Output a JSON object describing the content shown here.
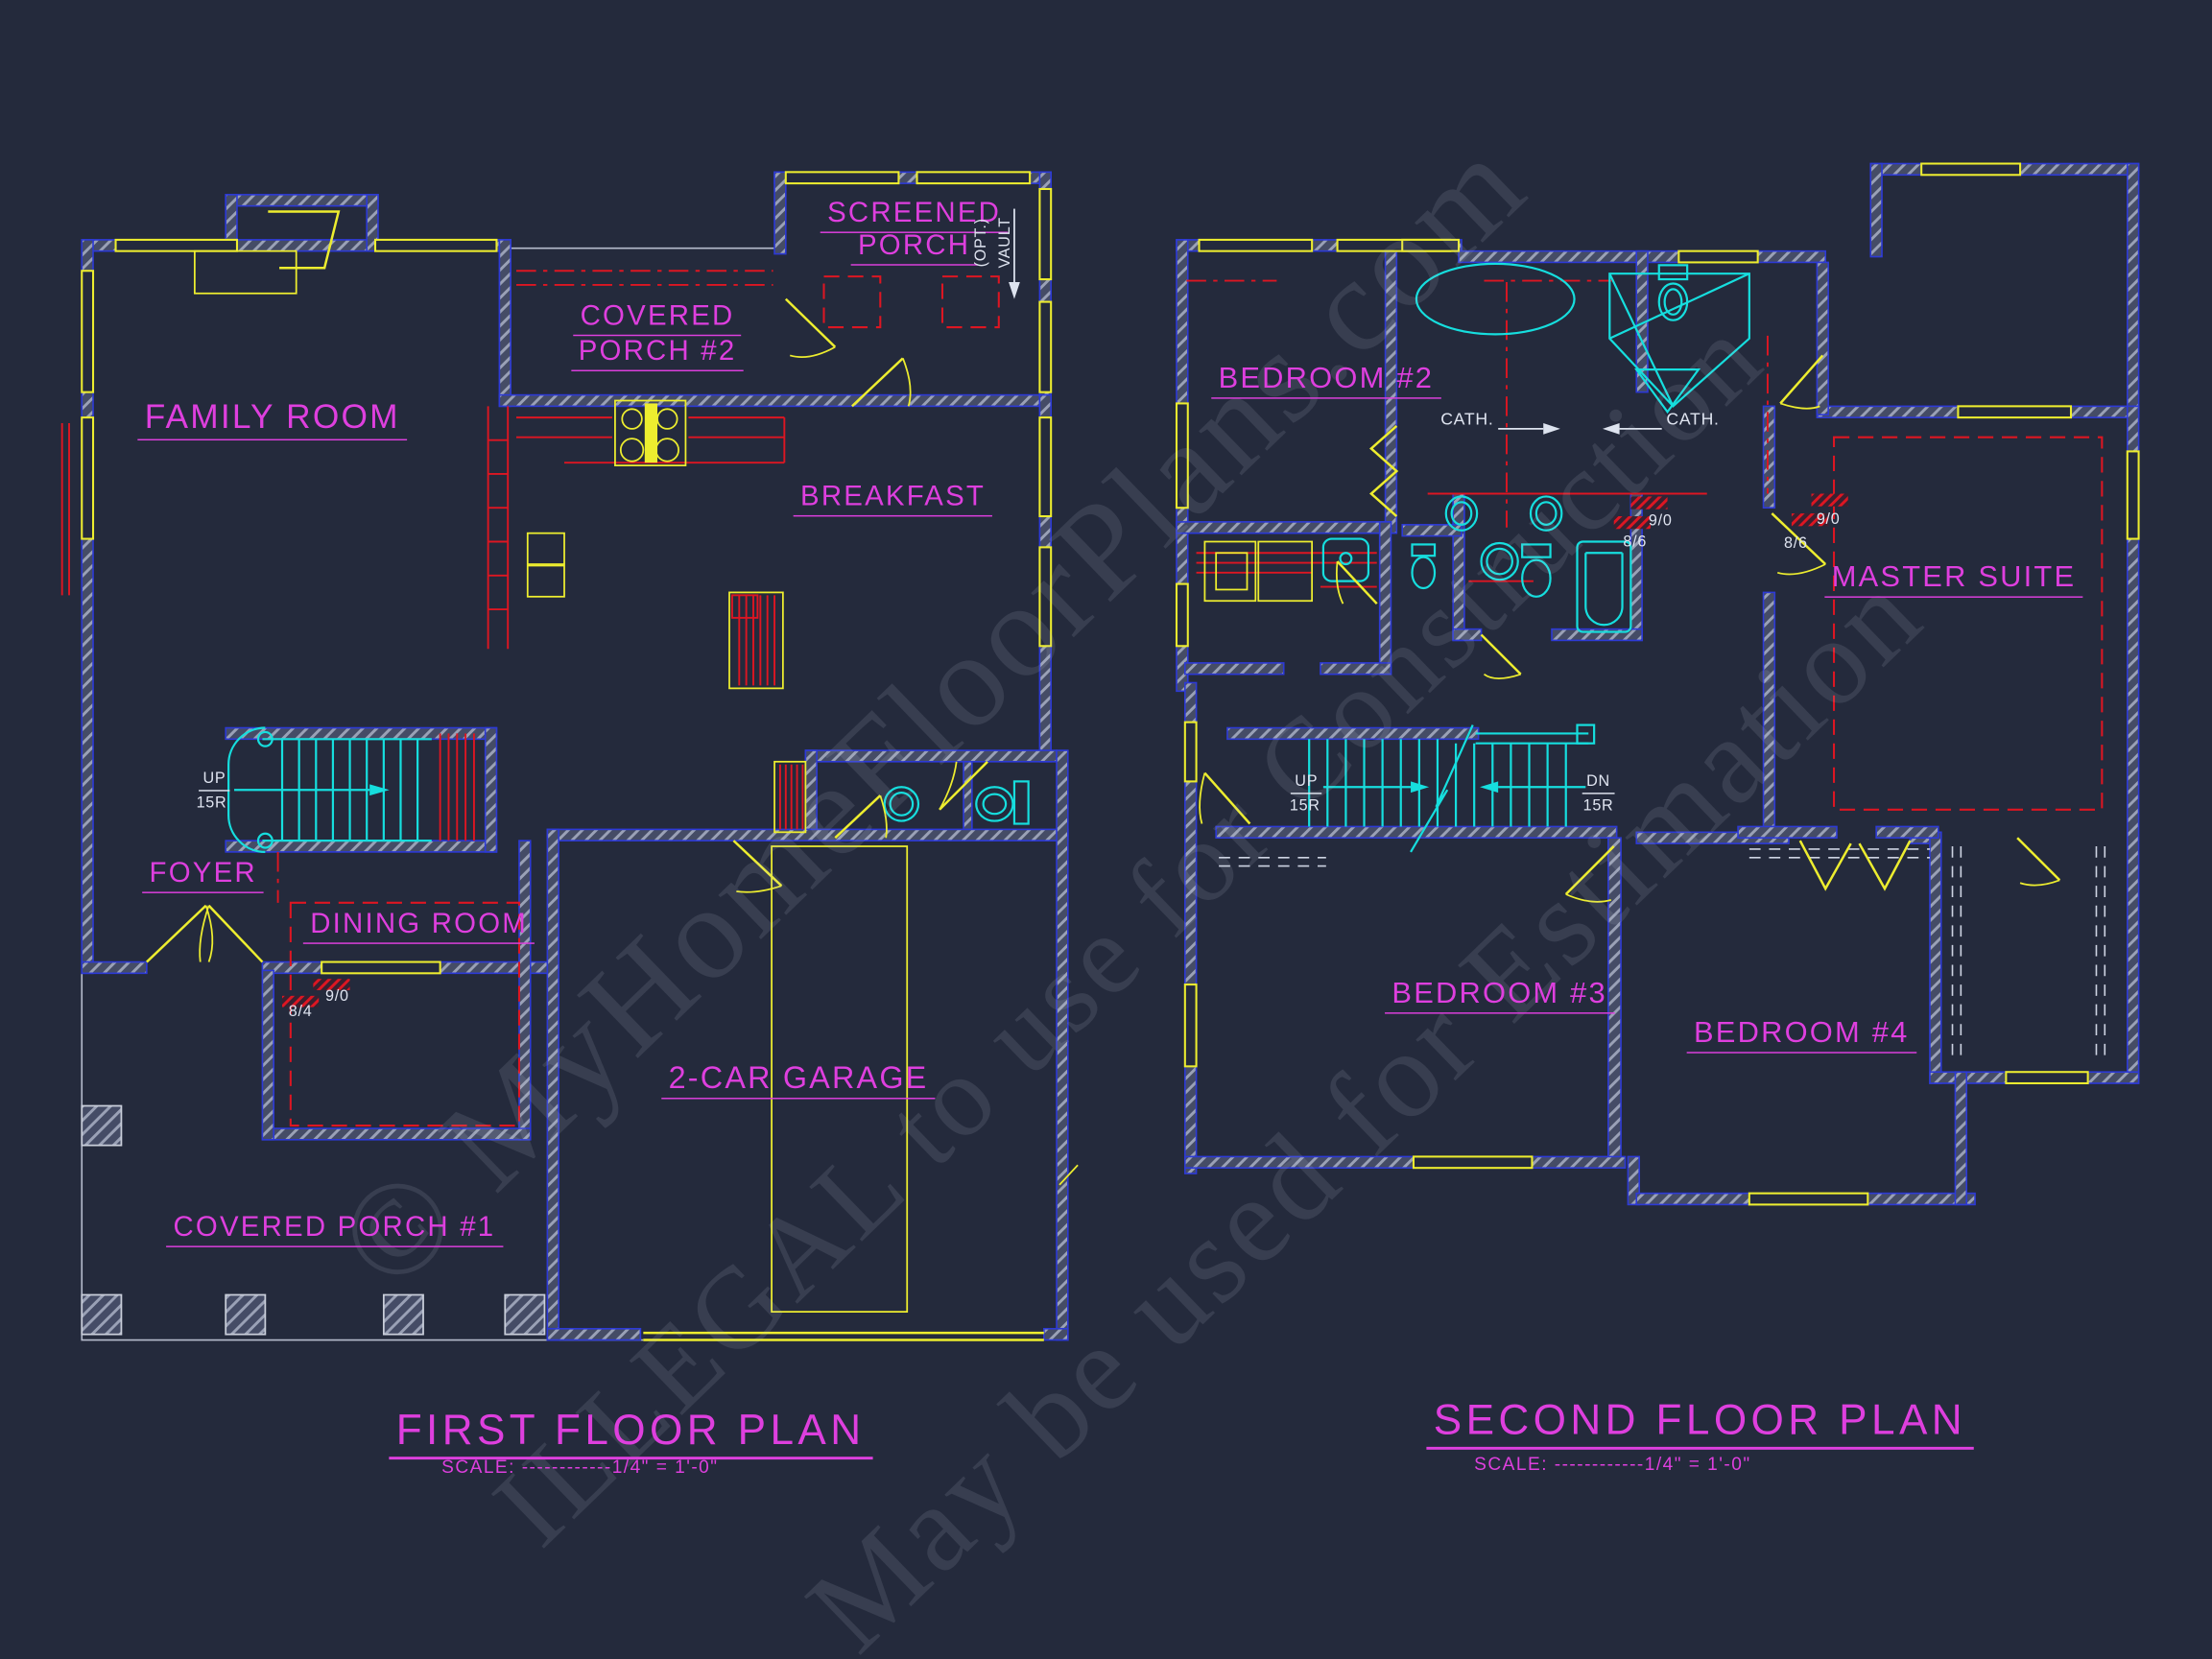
{
  "palette": {
    "background": "#242a3c",
    "wall_line": "#2d3ad6",
    "wall_hatch": "#9aa1b6",
    "room_label": "#de3fde",
    "doors_windows": "#eded2f",
    "fixtures_stairs": "#16dede",
    "counters_ceiling": "#dd1622",
    "annotation": "#dfe4f0",
    "porch_slab": "#b6bccd"
  },
  "watermark": {
    "line1": "© MyHomeFloorPlans.com",
    "line2": "ILLEGAL to use for Construction",
    "line3": "May be used for Estimation"
  },
  "first_floor": {
    "title": "FIRST FLOOR PLAN",
    "scale": "SCALE: ------------1/4\" = 1'-0\"",
    "rooms": {
      "family_room": "FAMILY ROOM",
      "covered_porch_2_line1": "COVERED",
      "covered_porch_2_line2": "PORCH #2",
      "screened_porch_line1": "SCREENED",
      "screened_porch_line2": "PORCH",
      "breakfast": "BREAKFAST",
      "foyer": "FOYER",
      "dining_room": "DINING ROOM",
      "garage": "2-CAR GARAGE",
      "covered_porch_1": "COVERED PORCH #1"
    },
    "annotations": {
      "stair_up": "UP",
      "stair_up_risers": "15R",
      "ceiling_8_4": "8/4",
      "ceiling_9_0": "9/0",
      "opt": "(OPT.)",
      "vault": "VAULT"
    }
  },
  "second_floor": {
    "title": "SECOND FLOOR PLAN",
    "scale": "SCALE: ------------1/4\" = 1'-0\"",
    "rooms": {
      "bedroom_2": "BEDROOM #2",
      "master_suite": "MASTER SUITE",
      "bedroom_3": "BEDROOM #3",
      "bedroom_4": "BEDROOM #4"
    },
    "annotations": {
      "cath_left": "CATH.",
      "cath_right": "CATH.",
      "stair_up": "UP",
      "stair_up_risers": "15R",
      "stair_dn": "DN",
      "stair_dn_risers": "15R",
      "ceiling_9_0_left": "9/0",
      "ceiling_8_6_left": "8/6",
      "ceiling_9_0_right": "9/0",
      "ceiling_8_6_right": "8/6"
    }
  }
}
